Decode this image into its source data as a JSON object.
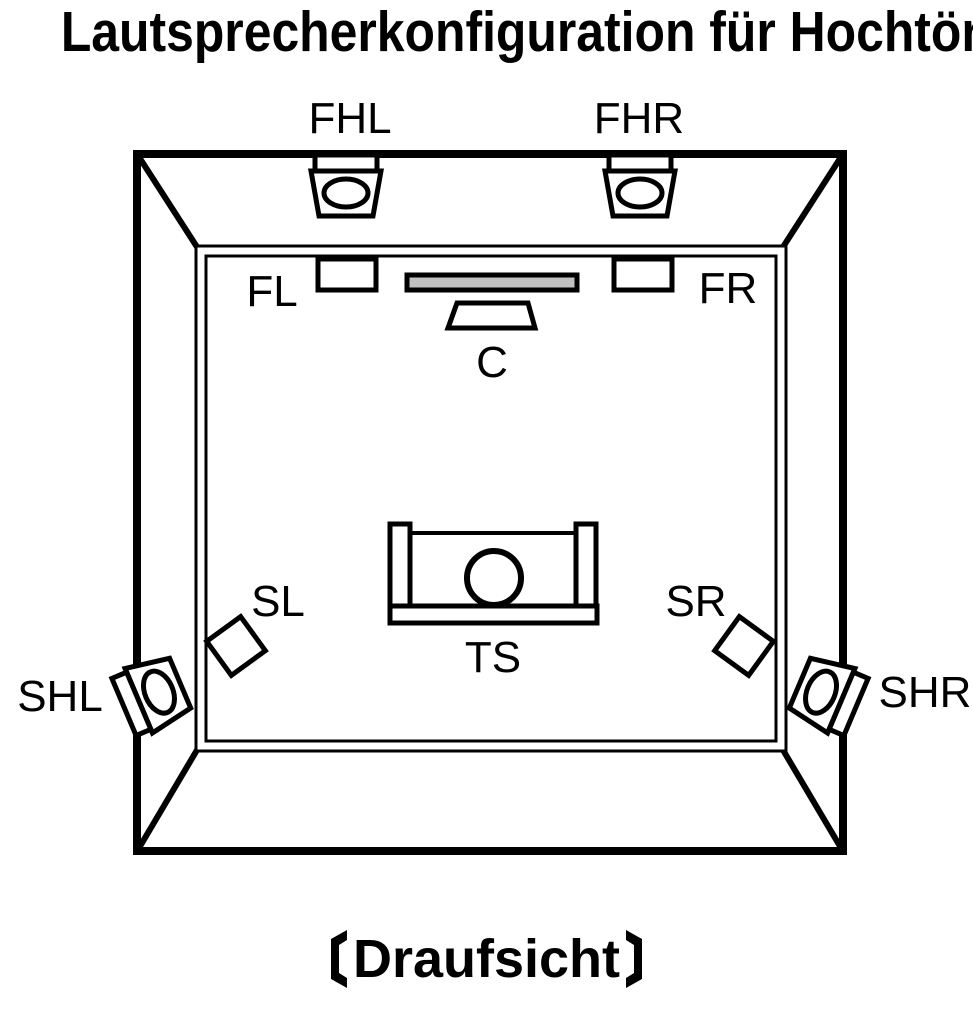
{
  "title": "Lautsprecherkonfiguration für Hochtöner",
  "view_caption": "Draufsicht",
  "diagram": {
    "type": "speaker-configuration-top-view",
    "labels": {
      "front_height_left": "FHL",
      "front_height_right": "FHR",
      "front_left": "FL",
      "front_right": "FR",
      "center": "C",
      "surround_left": "SL",
      "surround_right": "SR",
      "surround_height_left": "SHL",
      "surround_height_right": "SHR",
      "listening_seat": "TS"
    },
    "colors": {
      "line": "#000000",
      "background": "#ffffff",
      "tv_fill": "#c0c0c0"
    }
  }
}
